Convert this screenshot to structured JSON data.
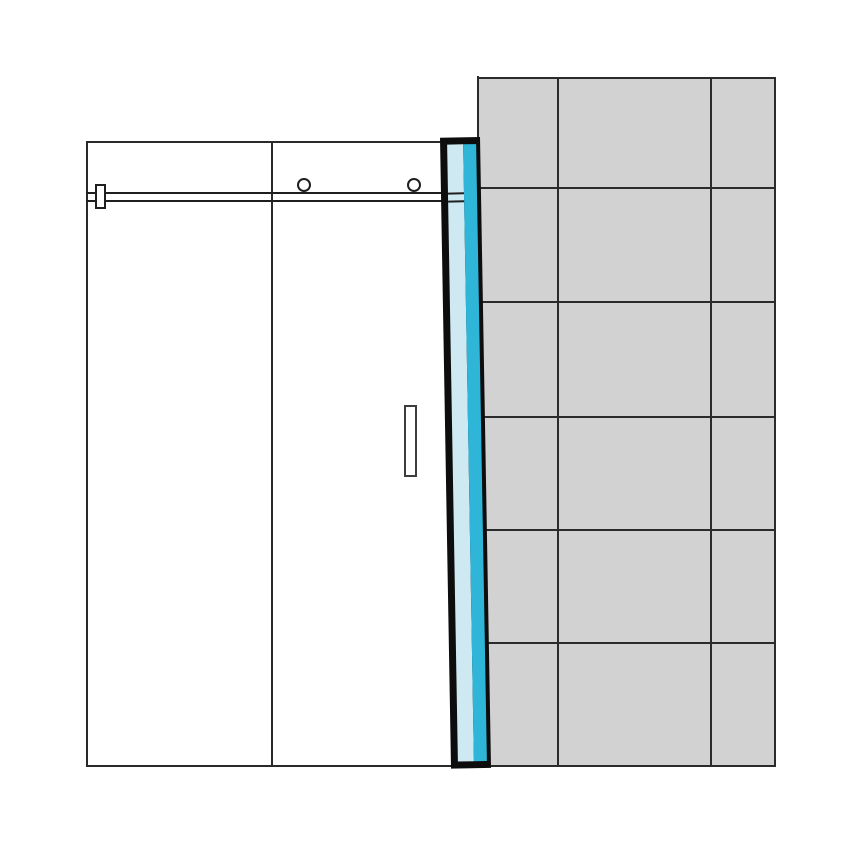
{
  "canvas": {
    "width": 866,
    "height": 845,
    "background": "#ffffff"
  },
  "colors": {
    "line": "#1f1f1f",
    "panel_border": "#2a2a2a",
    "grout": "#2b2b2b",
    "tile_fill": "#d2d2d2",
    "profile_frame": "#0d0d0d",
    "profile_glass": "#cfe9f2",
    "profile_seal": "#2fb5d8",
    "handle_border": "#3d3d3d",
    "white": "#ffffff"
  },
  "wall": {
    "rect": {
      "x": 470,
      "y": 77,
      "w": 305.5,
      "h": 689.5,
      "fill": "#d2d2d2",
      "css": {
        "border": "2px solid #2b2b2b"
      }
    },
    "vlines": {
      "dir": "v",
      "offsets": [
        85,
        238
      ],
      "thickness": 2,
      "color": "#2b2b2b"
    },
    "hlines": {
      "dir": "h",
      "offsets": [
        108,
        222,
        337,
        450,
        563
      ],
      "thickness": 2,
      "color": "#2b2b2b"
    },
    "edge_mask": {
      "x": 452,
      "y": 76,
      "w": 27,
      "h": 63,
      "fill": "#ffffff",
      "css": {
        "borderRight": "2px solid #2b2b2b"
      }
    }
  },
  "panels": {
    "rect": {
      "x": 86,
      "y": 141,
      "w": 376,
      "h": 625.5,
      "fill": "#ffffff",
      "css": {
        "borderLeft": "2.2px solid #2a2a2a",
        "borderTop": "2.2px solid #2a2a2a",
        "borderBottom": "2.2px solid #2a2a2a"
      }
    },
    "divider": {
      "x": 271,
      "y": 141,
      "w": 2.2,
      "h": 625.5,
      "fill": "#2a2a2a"
    }
  },
  "rail": {
    "top_line": {
      "x": 86,
      "y": 192.3,
      "w": 375,
      "h": 2.2,
      "fill": "#1f1f1f"
    },
    "bottom_line": {
      "x": 86,
      "y": 199.8,
      "w": 375,
      "h": 2.2,
      "fill": "#1f1f1f"
    },
    "bracket": {
      "x": 95,
      "y": 183.5,
      "w": 11,
      "h": 25.5,
      "fill": "#ffffff",
      "css": {
        "border": "2px solid #1f1f1f"
      }
    }
  },
  "rollers": {
    "left": {
      "x": 297,
      "y": 178,
      "w": 14,
      "h": 14,
      "fill": "#ffffff",
      "css": {
        "border": "2px solid #1f1f1f"
      }
    },
    "right": {
      "x": 407.3,
      "y": 178,
      "w": 14,
      "h": 14,
      "fill": "#ffffff",
      "css": {
        "border": "2px solid #1f1f1f"
      }
    }
  },
  "handle": {
    "rect": {
      "x": 404,
      "y": 405,
      "w": 12.5,
      "h": 71.5,
      "fill": "#ffffff",
      "css": {
        "border": "2.2px solid #3d3d3d"
      }
    }
  },
  "profile": {
    "rect": {
      "x": 440,
      "y": 137,
      "w": 40,
      "h": 631,
      "fill": "#0d0d0d",
      "angle": -1
    },
    "light_band": {
      "x": 7,
      "y": 7,
      "w": 15.5,
      "h": 617,
      "fill": "#cfe9f2"
    },
    "dark_band": {
      "x": 22.5,
      "y": 7,
      "w": 13.5,
      "h": 617,
      "fill": "#2fb5d8"
    },
    "rail_stub_top": {
      "x": 7,
      "y": 55.2,
      "w": 15.5,
      "h": 2.2,
      "fill": "#1f1f1f"
    },
    "rail_stub_bottom": {
      "x": 7,
      "y": 62.8,
      "w": 15.5,
      "h": 2.2,
      "fill": "#1f1f1f"
    }
  }
}
